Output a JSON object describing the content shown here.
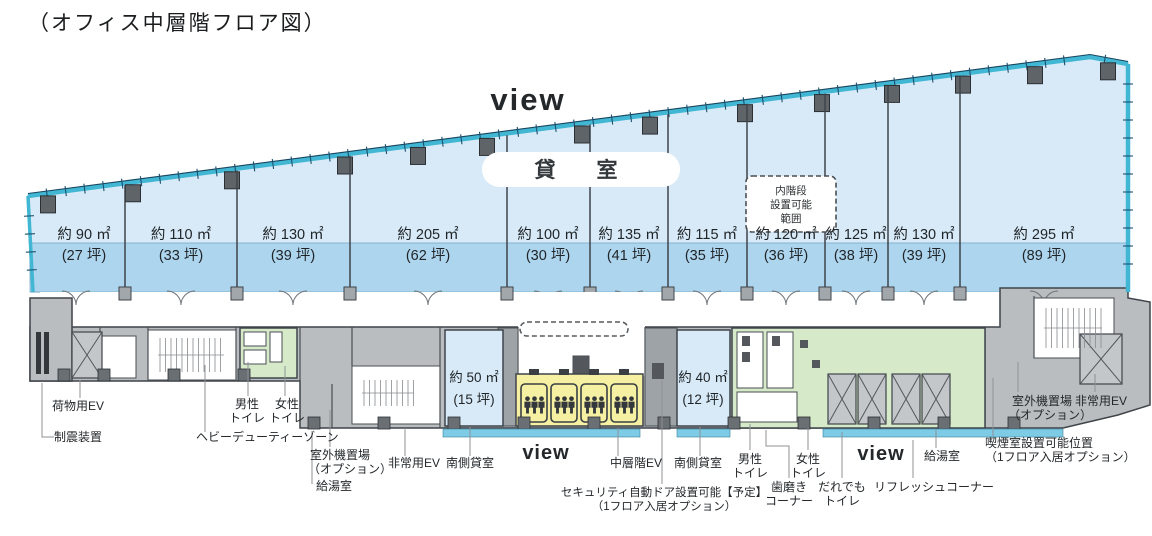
{
  "page": {
    "title": "（オフィス中層階フロア図）"
  },
  "plan": {
    "view_top": "view",
    "rental_label": "貸　室",
    "inner_stair_box": {
      "line1": "内階段",
      "line2": "設置可能",
      "line3": "範囲"
    },
    "rooms": [
      {
        "area": "約 90 ㎡",
        "tsubo": "(27 坪)"
      },
      {
        "area": "約 110 ㎡",
        "tsubo": "(33 坪)"
      },
      {
        "area": "約 130 ㎡",
        "tsubo": "(39 坪)"
      },
      {
        "area": "約 205 ㎡",
        "tsubo": "(62 坪)"
      },
      {
        "area": "約 100 ㎡",
        "tsubo": "(30 坪)"
      },
      {
        "area": "約 135 ㎡",
        "tsubo": "(41 坪)"
      },
      {
        "area": "約 115 ㎡",
        "tsubo": "(35 坪)"
      },
      {
        "area": "約 120 ㎡",
        "tsubo": "(36 坪)"
      },
      {
        "area": "約 125 ㎡",
        "tsubo": "(38 坪)"
      },
      {
        "area": "約 130 ㎡",
        "tsubo": "(39 坪)"
      },
      {
        "area": "約 295 ㎡",
        "tsubo": "(89 坪)"
      }
    ],
    "south_rooms": [
      {
        "area": "約 50 ㎡",
        "tsubo": "(15 坪)"
      },
      {
        "area": "約 40 ㎡",
        "tsubo": "(12 坪)"
      }
    ],
    "labels": {
      "seismic_damper": "制震装置",
      "cargo_ev": "荷物用EV",
      "heavy_duty_zone": "ヘビーデューティーゾーン",
      "mens_toilet_left": {
        "line1": "男性",
        "line2": "トイレ"
      },
      "womens_toilet_left": {
        "line1": "女性",
        "line2": "トイレ"
      },
      "outdoor_unit_left": {
        "line1": "室外機置場",
        "line2": "（オプション）"
      },
      "kitchenette_left": "給湯室",
      "emergency_ev_left": "非常用EV",
      "south_rental_left": "南側貸室",
      "view_bottom_left": "view",
      "mid_floor_ev": "中層階EV",
      "south_rental_right": "南側貸室",
      "security_door": {
        "line1": "セキュリティ自動ドア設置可能【予定】",
        "line2": "（1フロア入居オプション）"
      },
      "mens_toilet_right": {
        "line1": "男性",
        "line2": "トイレ"
      },
      "womens_toilet_right": {
        "line1": "女性",
        "line2": "トイレ"
      },
      "tooth_brushing": {
        "line1": "歯磨き",
        "line2": "コーナー"
      },
      "accessible_toilet": {
        "line1": "だれでも",
        "line2": "トイレ"
      },
      "view_bottom_right": "view",
      "refresh_corner": "リフレッシュコーナー",
      "kitchenette_right": "給湯室",
      "smoking_room": {
        "line1": "喫煙室設置可能位置",
        "line2": "（1フロア入居オプション）"
      },
      "outdoor_unit_right": {
        "line1": "室外機置場",
        "line2": "（オプション）"
      },
      "emergency_ev_right": "非常用EV"
    },
    "colors": {
      "tenant_area": "#d8eaf8",
      "area_band": "#aed5ee",
      "facade": "#41b7d3",
      "view_text": "#1b9cd8",
      "core_gray": "#b9bdc0",
      "toilet_green": "#d6e9c8",
      "elevator_yellow": "#f5f0a2",
      "wall_dark": "#44484c"
    }
  }
}
